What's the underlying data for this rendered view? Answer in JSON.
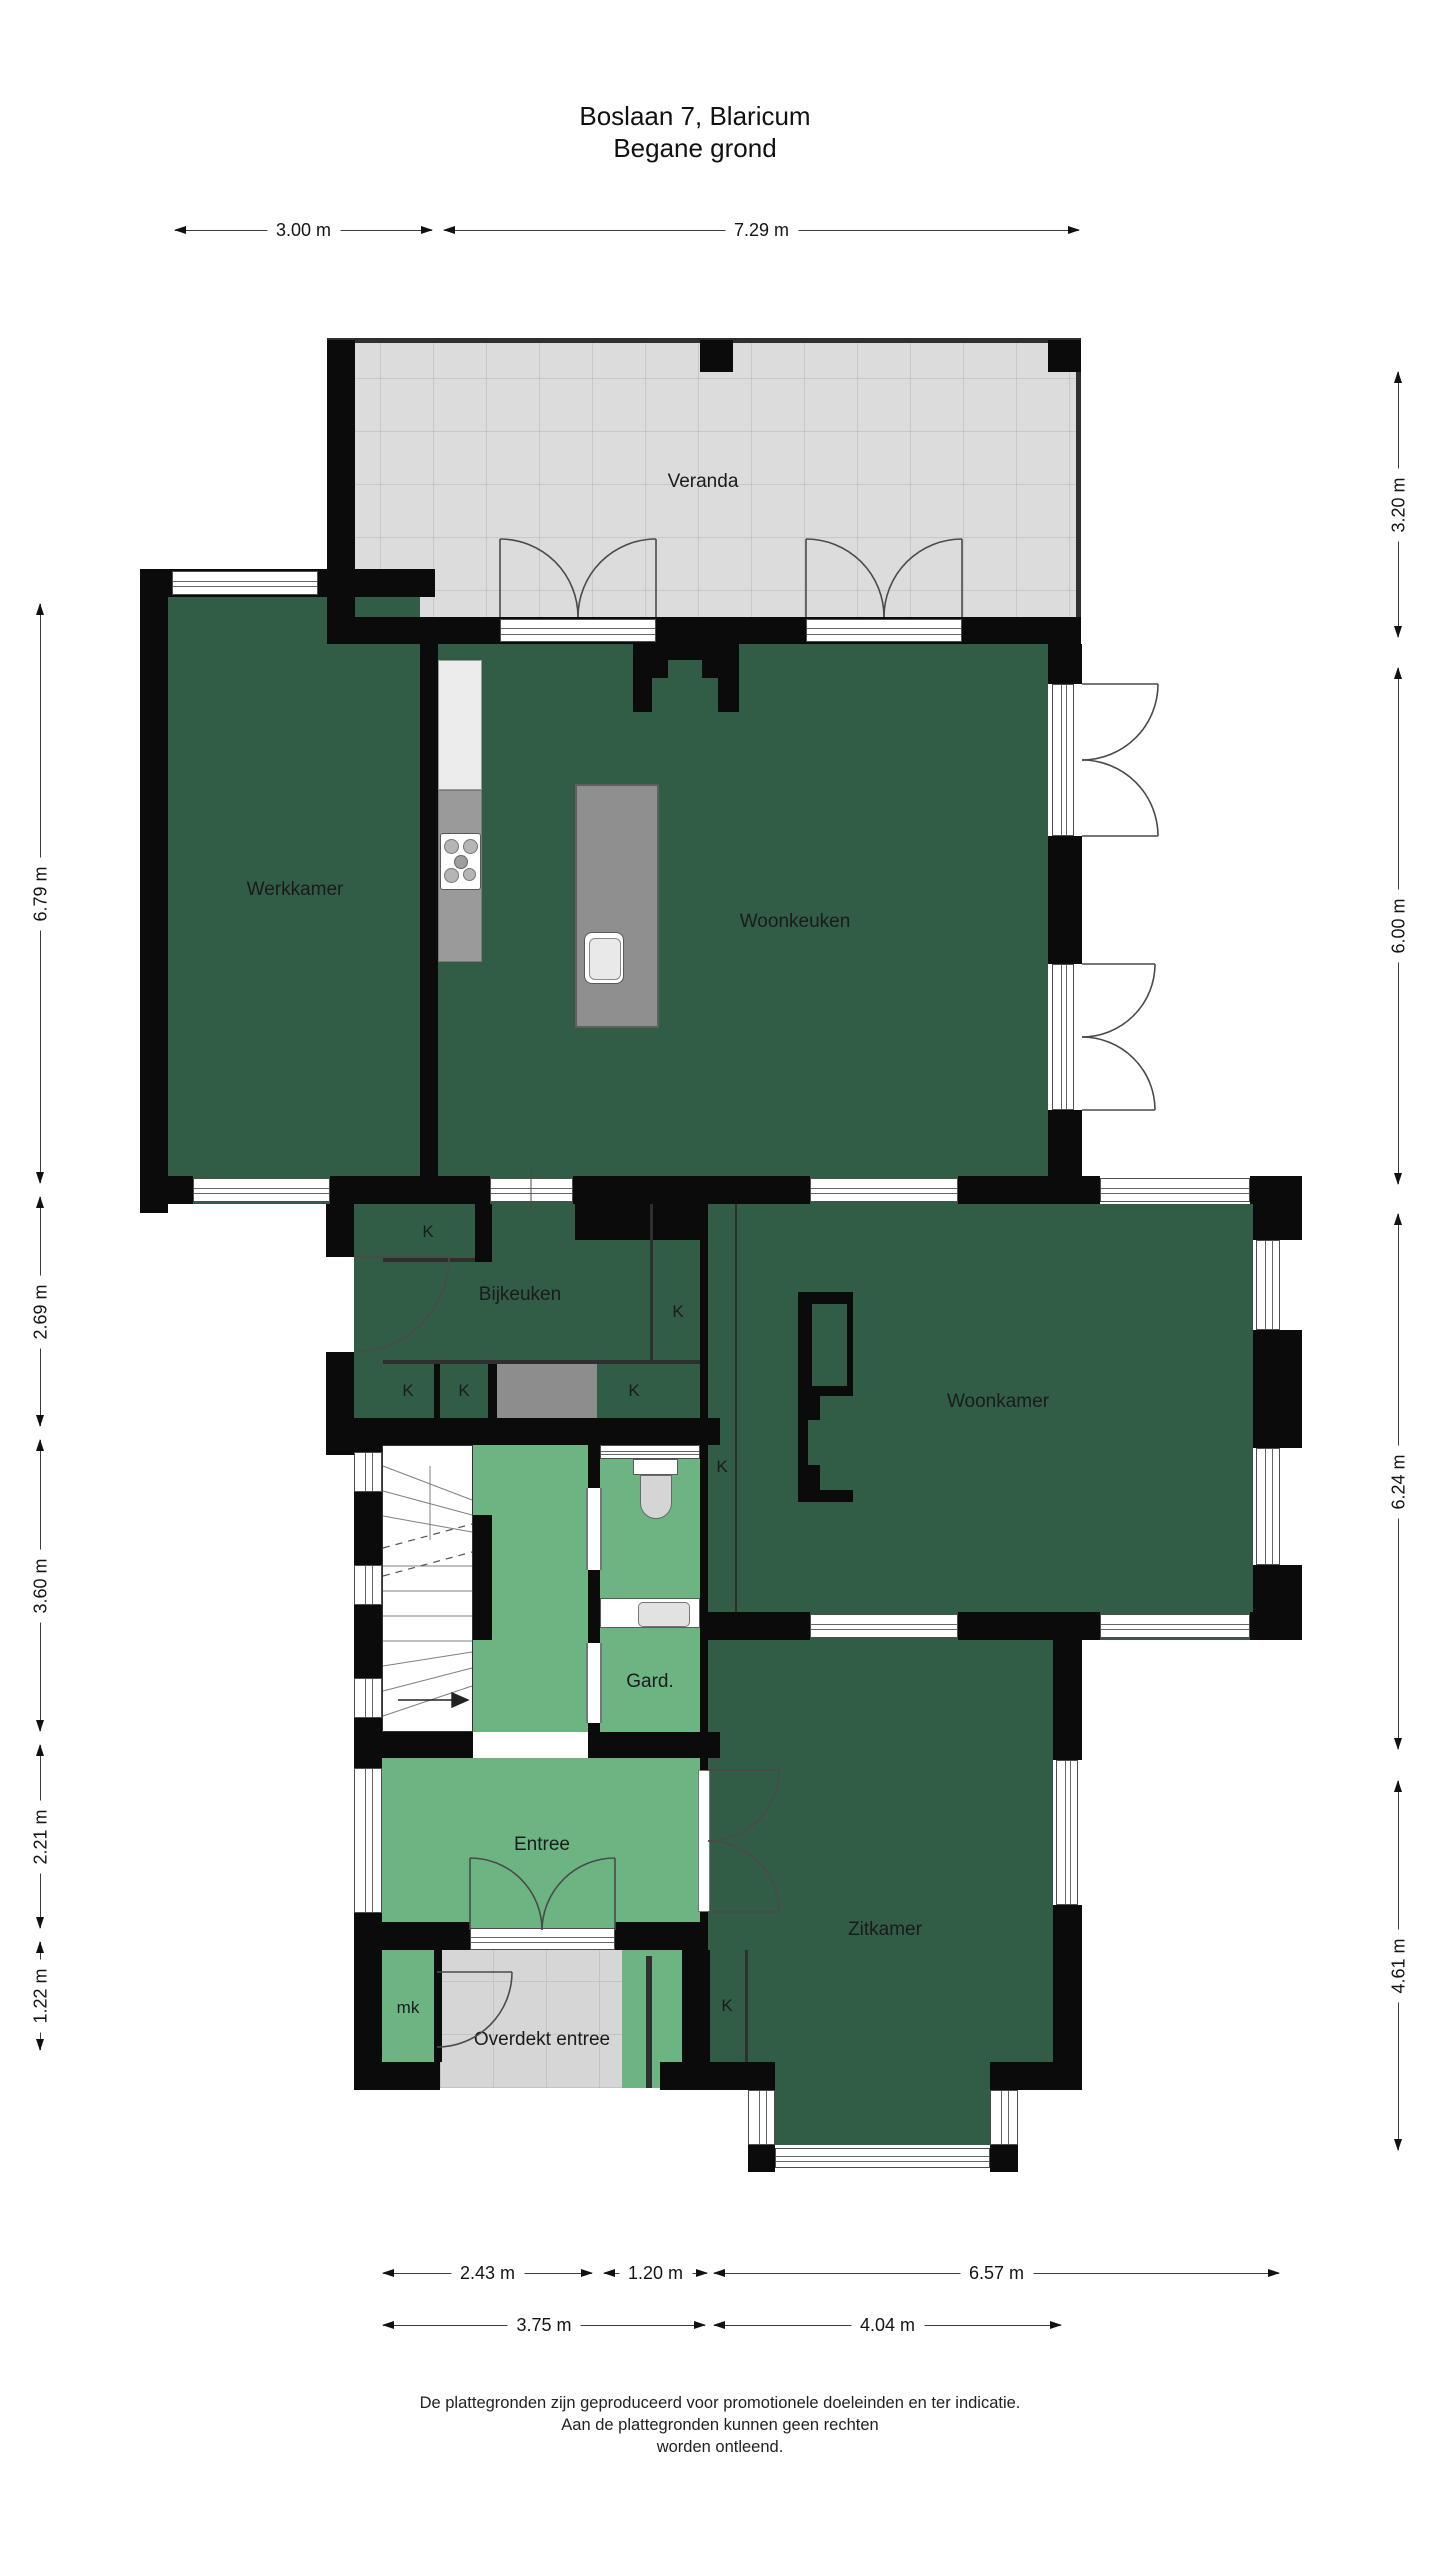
{
  "title": {
    "line1": "Boslaan 7, Blaricum",
    "line2": "Begane grond"
  },
  "rooms": {
    "veranda": "Veranda",
    "werkkamer": "Werkkamer",
    "woonkeuken": "Woonkeuken",
    "bijkeuken": "Bijkeuken",
    "woonkamer": "Woonkamer",
    "entree": "Entree",
    "garderobe": "Gard.",
    "zitkamer": "Zitkamer",
    "overdekt_entree": "Overdekt entree",
    "meterkast": "mk",
    "closet": "K"
  },
  "dimensions": {
    "top": [
      "3.00 m",
      "7.29 m"
    ],
    "left": [
      "6.79 m",
      "2.69 m",
      "3.60 m",
      "2.21 m",
      "1.22 m"
    ],
    "right": [
      "3.20 m",
      "6.00 m",
      "6.24 m",
      "4.61 m"
    ],
    "bottom_row1": [
      "2.43 m",
      "1.20 m",
      "6.57 m"
    ],
    "bottom_row2": [
      "3.75 m",
      "4.04 m"
    ]
  },
  "footer": {
    "line1": "De plattegronden zijn geproduceerd voor promotionele doeleinden en ter indicatie.",
    "line2": "Aan de plattegronden kunnen geen rechten",
    "line3": "worden ontleend."
  },
  "colors": {
    "room_dark_green": "#315C45",
    "room_light_green": "#6CB583",
    "veranda_gray": "#DCDCDC",
    "island_gray": "#8F8F8F",
    "counter_gray": "#9A9A9A",
    "wall_black": "#0B0B0B"
  }
}
